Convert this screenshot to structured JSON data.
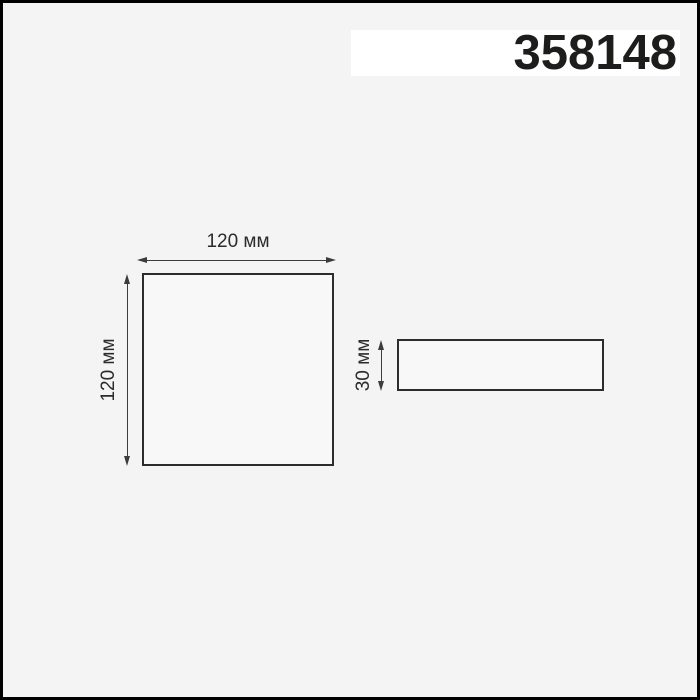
{
  "page": {
    "frame_color": "#000000",
    "background": "#f4f4f4"
  },
  "header": {
    "article_number": "358148"
  },
  "diagram": {
    "line_color": "#2c2c2c",
    "front_view": {
      "width_label": "120 мм",
      "height_label": "120 мм"
    },
    "side_view": {
      "height_label": "30 мм"
    }
  }
}
